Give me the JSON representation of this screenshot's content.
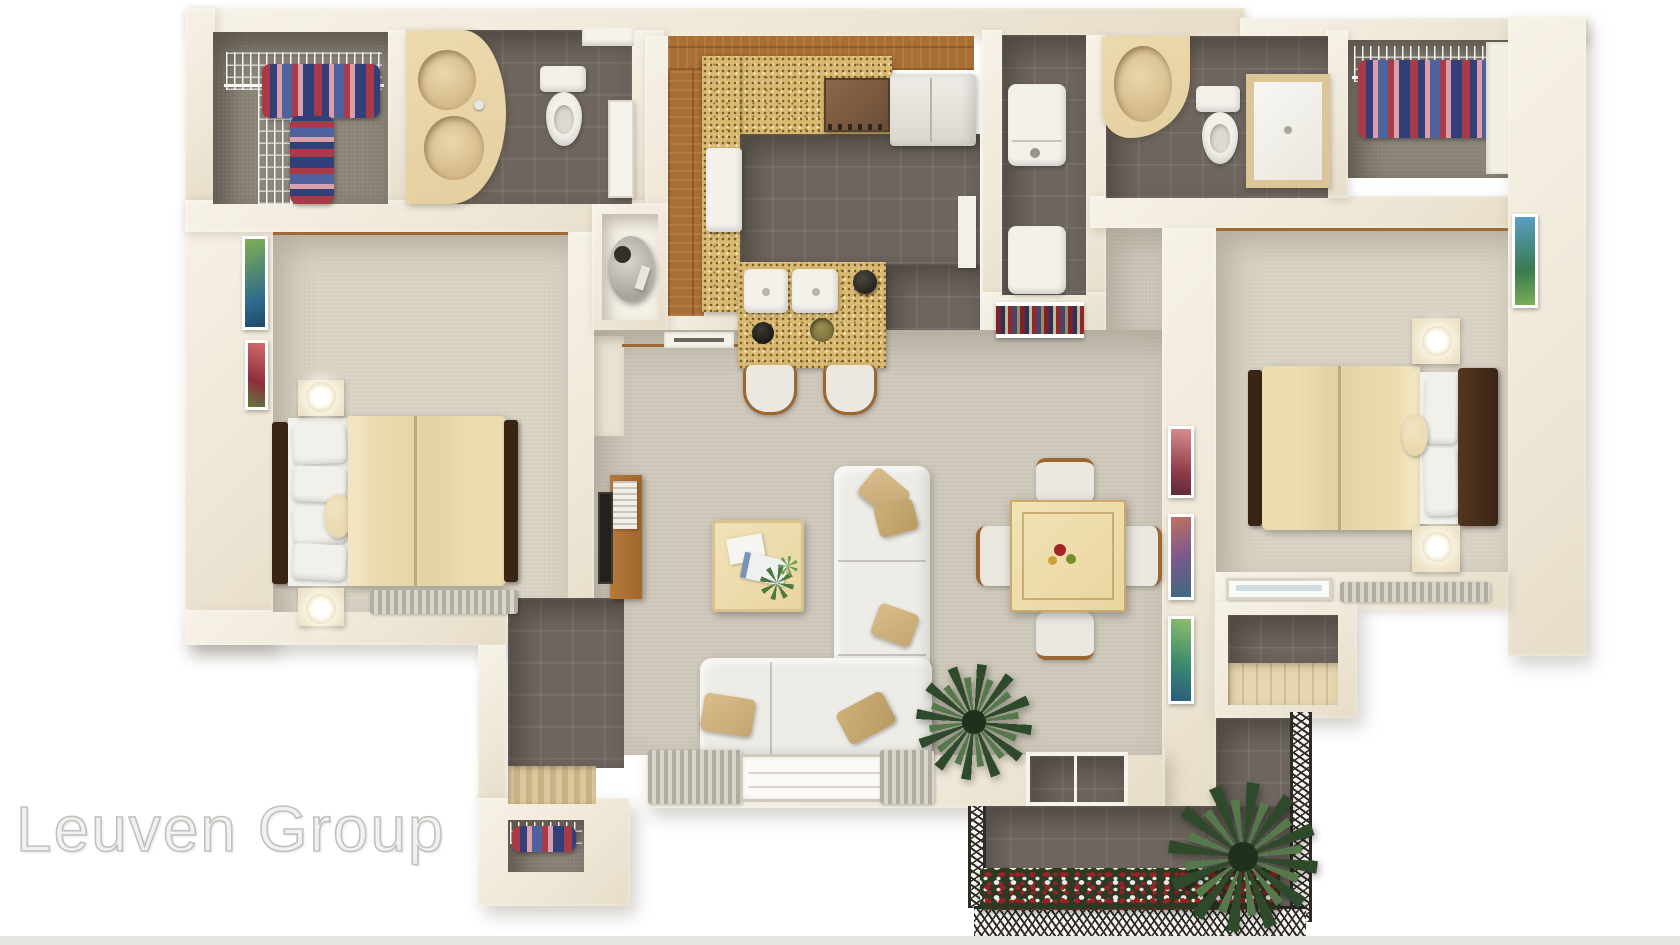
{
  "watermark": {
    "text": "Leuven Group"
  },
  "palette": {
    "background": "#ffffff",
    "bottom_strip": "#e6e4e0",
    "wall": "#f2ecdf",
    "carpet_bedroom": "#d7d1c2",
    "carpet_living": "#ccc6b8",
    "closet_floor": "#8b8478",
    "tile_dark": "#6e665f",
    "wood_floor": "#a96e33",
    "wood_trim": "#9c6a34",
    "granite": "#d9ba72",
    "vanity": "#e5cfa0",
    "sink_bowl": "#d4b988",
    "fixture_white": "#f3f1ea",
    "appliance": "#eceae3",
    "bed_frame": "#3a2514",
    "duvet": "#ecdcb0",
    "pillow_white": "#f2f0ea",
    "pillow_round": "#e8d5a8",
    "sofa": "#edece6",
    "pillow_tan": "#d9bd8b",
    "table_wood": "#ead5a0",
    "console_wood": "#a2672e",
    "tv_screen": "#24211d",
    "plant_dark": "#2f4a2b",
    "plant_light": "#55794a",
    "flower_bed": "#2c3a23",
    "flower_red": "#9e2026",
    "flower_white": "#edeee4",
    "clothes_red": "#a93a48",
    "clothes_navy": "#31407a",
    "clothes_pink": "#d9a0ac",
    "clothes_blue": "#50619f",
    "railing": "#2e2b27",
    "curtain": "#b2ada1",
    "watermark_fill": "#f2f1ef",
    "watermark_stroke": "#c2c0bc"
  }
}
